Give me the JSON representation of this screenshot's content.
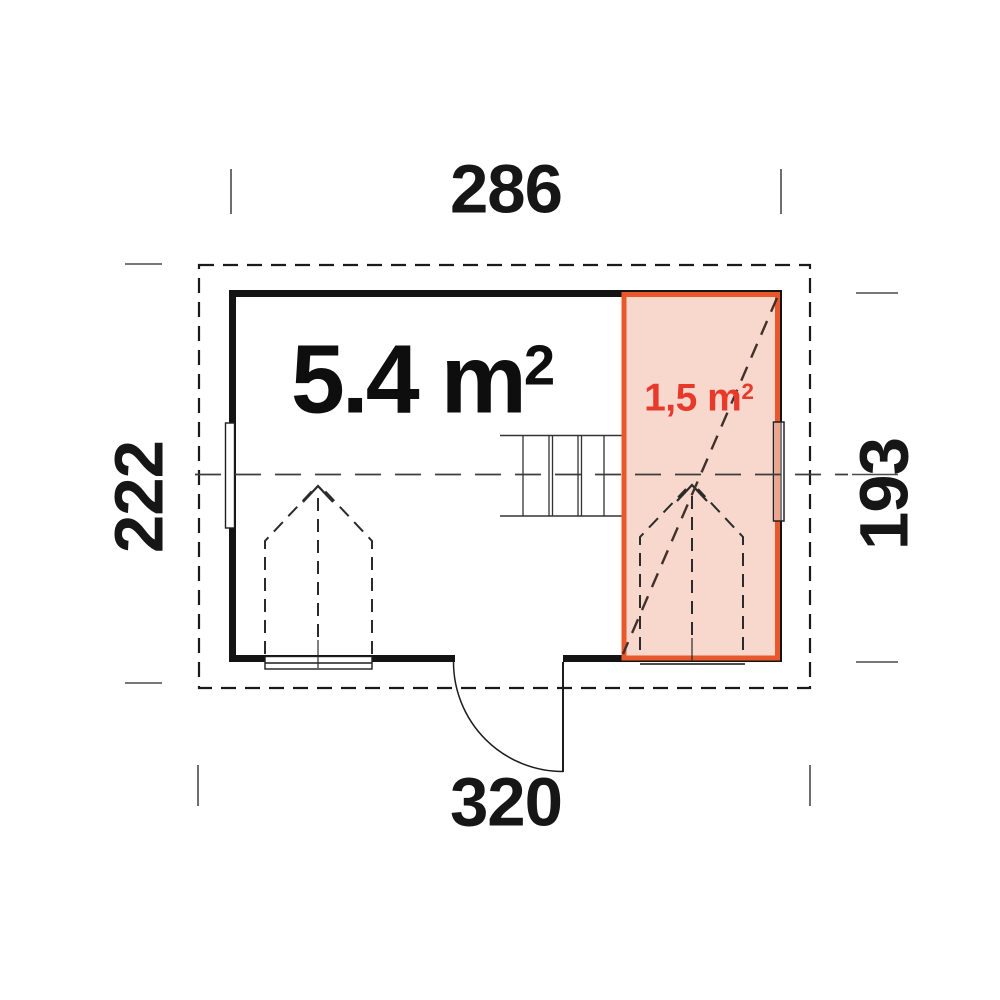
{
  "plan": {
    "dimensions": {
      "top": "286",
      "left": "222",
      "right": "193",
      "bottom": "320"
    },
    "areas": {
      "main": {
        "text": "5.4 m",
        "exponent": "2"
      },
      "annex": {
        "text": "1,5 m",
        "exponent": "2"
      }
    },
    "colors": {
      "wall": "#141414",
      "annex_border": "#e8582b",
      "annex_fill": "#f8d8cc",
      "annex_text": "#e73a2b"
    }
  }
}
